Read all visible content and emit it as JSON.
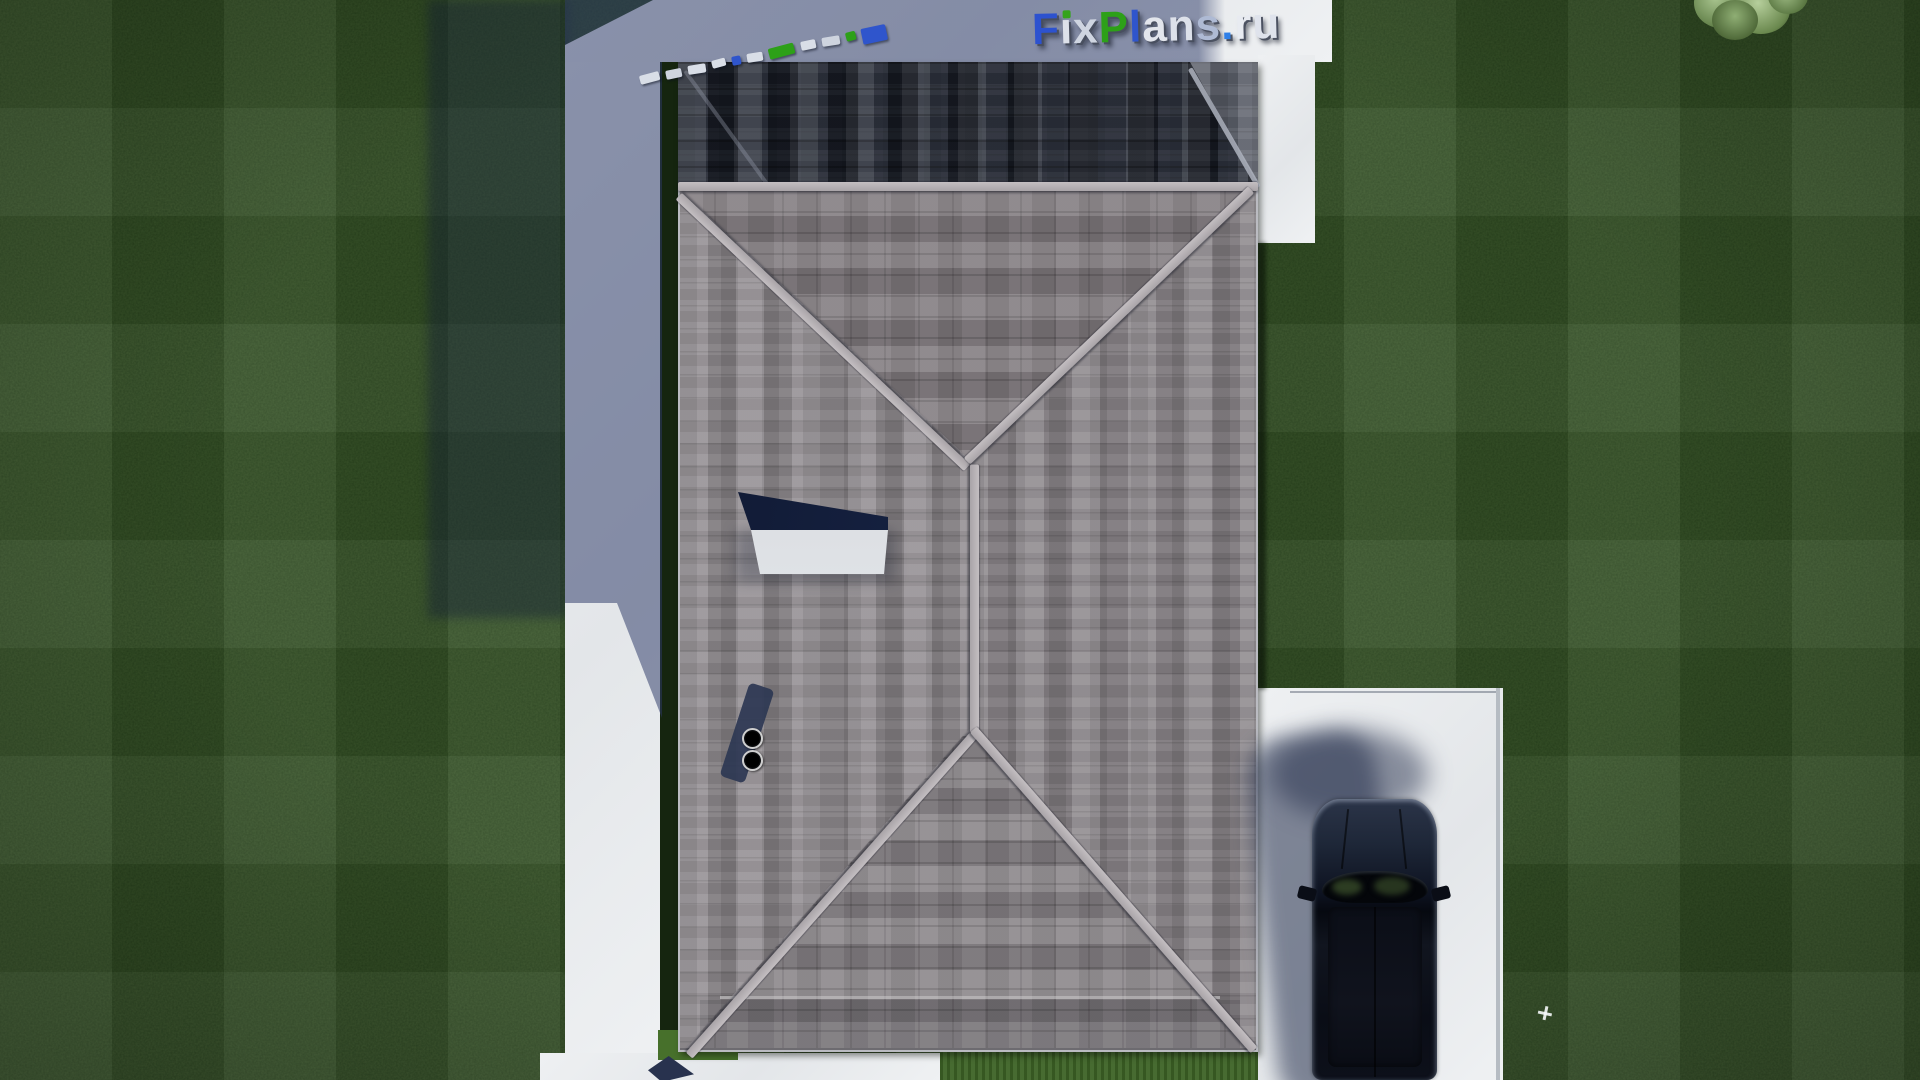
{
  "watermark": {
    "text": "FixPlans.ru",
    "letters": [
      {
        "ch": "F",
        "color": "#2d52cf"
      },
      {
        "ch": "ı",
        "color": "#dde1ea",
        "dot": "#35a31c"
      },
      {
        "ch": "x",
        "color": "#cfd5e1"
      },
      {
        "ch": "P",
        "color": "#2da018"
      },
      {
        "ch": "l",
        "color": "#2f55cc"
      },
      {
        "ch": "a",
        "color": "#e2e5ec"
      },
      {
        "ch": "n",
        "color": "#dde1ea"
      },
      {
        "ch": "s",
        "color": "#aebad4"
      },
      {
        "ch": ".",
        "color": "#2e7fe8"
      },
      {
        "ch": "r",
        "color": "#e8ebf1"
      },
      {
        "ch": "u",
        "color": "#dfe3ec"
      }
    ]
  },
  "edge_bars": {
    "items": [
      {
        "color": "#d9dee7",
        "w": 20,
        "h": 9
      },
      {
        "color": "#ced4df",
        "w": 16,
        "h": 9
      },
      {
        "color": "#d9dee7",
        "w": 18,
        "h": 9
      },
      {
        "color": "#d9dee7",
        "w": 14,
        "h": 8
      },
      {
        "color": "#2f55cc",
        "w": 9,
        "h": 9
      },
      {
        "color": "#d9dee7",
        "w": 16,
        "h": 9
      },
      {
        "color": "#2da018",
        "w": 26,
        "h": 11
      },
      {
        "color": "#d9dee7",
        "w": 15,
        "h": 9
      },
      {
        "color": "#ced4df",
        "w": 18,
        "h": 9
      },
      {
        "color": "#2da018",
        "w": 10,
        "h": 9
      },
      {
        "color": "#2f55cc",
        "w": 25,
        "h": 16
      }
    ]
  },
  "palette": {
    "grass": "#2a451e",
    "grass_sunlit": "#3d6326",
    "grass_shadow_overlay": "rgba(16,26,52,0.40)",
    "concrete": "#eceef0",
    "concrete_shadow": "rgba(45,58,104,0.52)",
    "roof_base": "#8e898d",
    "roof_dark_band": "#1f2430",
    "ridge_cap": "#b4afb2",
    "skylight_glass": "#152145",
    "car_body": "#0c101c",
    "logo_blue": "#2d52cf",
    "logo_green": "#2da018"
  }
}
